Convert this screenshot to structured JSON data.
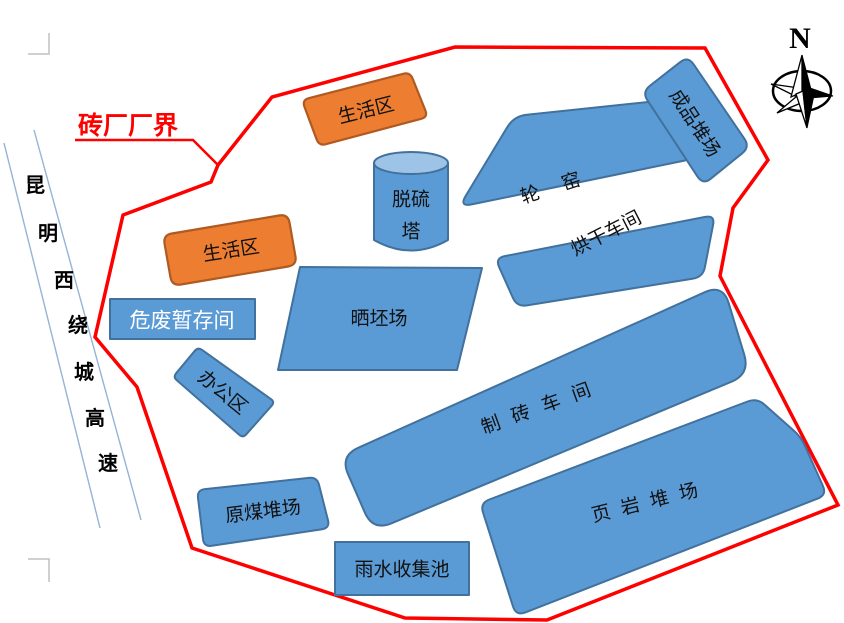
{
  "boundary": {
    "label": "砖厂厂界"
  },
  "compass": {
    "label": "N"
  },
  "road": {
    "name": "昆明西绕城高速",
    "chars": [
      "昆",
      "明",
      "西",
      "绕",
      "城",
      "高",
      "速"
    ]
  },
  "facilities": {
    "living_area_top": "生活区",
    "living_area_left": "生活区",
    "desulfurization_tower": {
      "line1": "脱硫",
      "line2": "塔"
    },
    "ring_kiln": "轮窑",
    "finished_product_yard": "成品堆场",
    "drying_workshop": "烘干车间",
    "hazardous_waste_storage": "危废暂存间",
    "brick_drying_field": "晒坯场",
    "office_area": "办公区",
    "brick_making_workshop": "制砖车间",
    "shale_yard": "页岩堆场",
    "raw_coal_yard": "原煤堆场",
    "rainwater_collection_pool": "雨水收集池"
  },
  "colors": {
    "building_fill": "#5B9BD5",
    "building_border": "#41719C",
    "tower_top_fill": "#9DC3E6",
    "living_fill": "#ED7D31",
    "living_border": "#AE5A21",
    "boundary_red": "#FF0000",
    "road_line_blue": "#95B3D7"
  }
}
